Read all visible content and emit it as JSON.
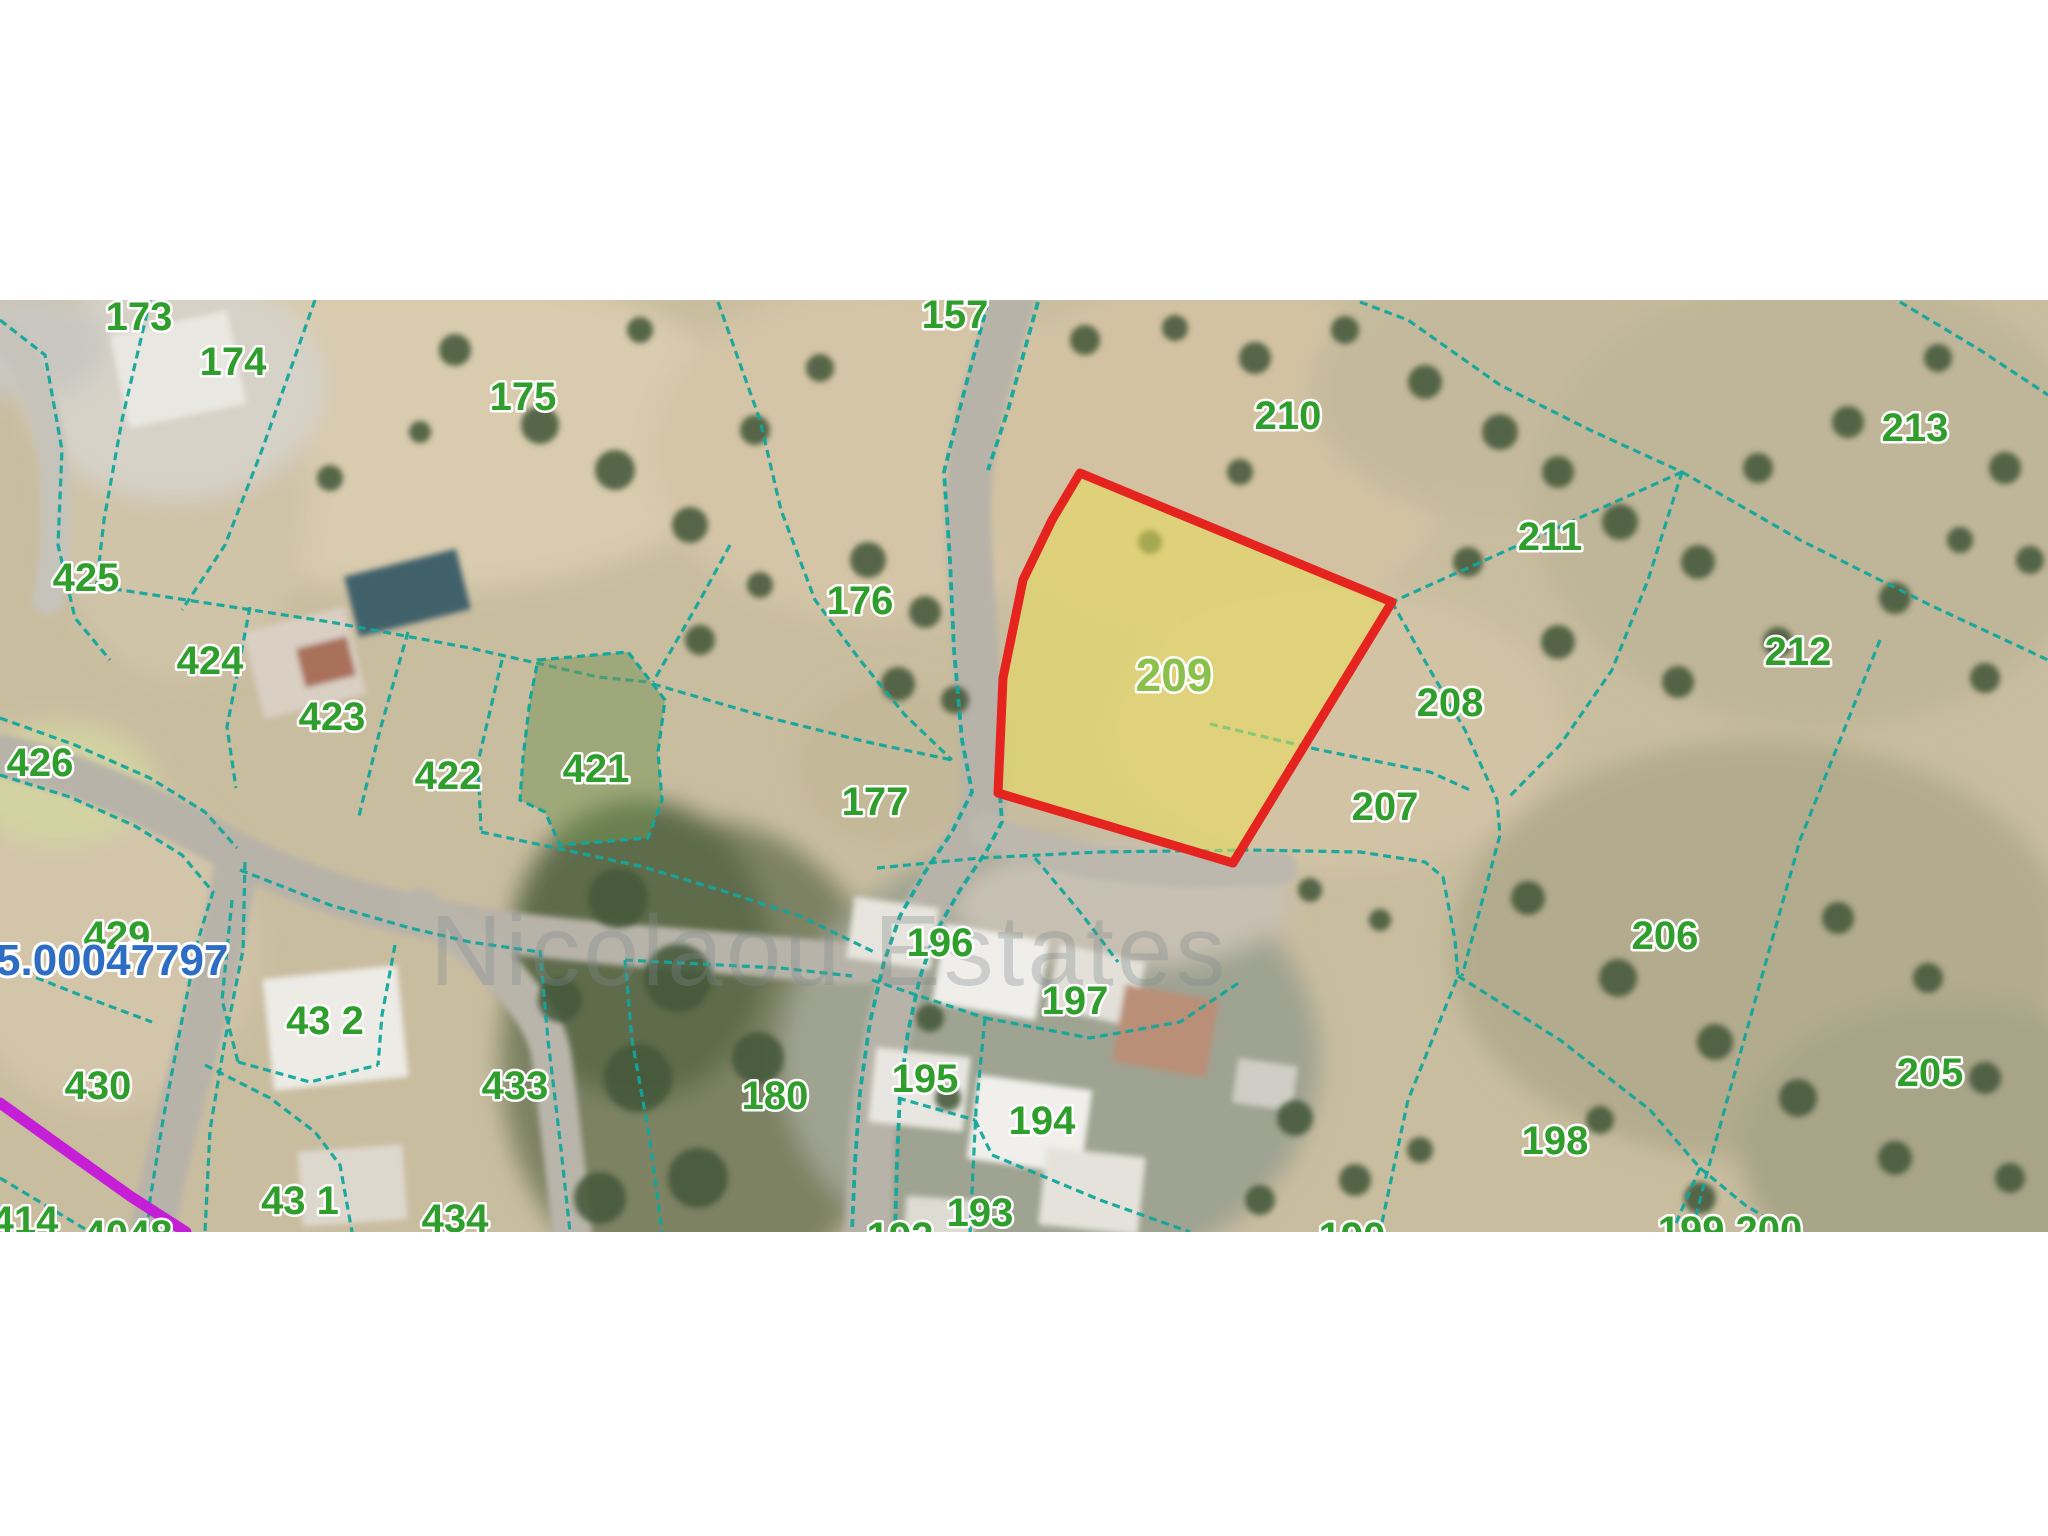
{
  "map": {
    "type": "cadastral-parcel-map",
    "area": {
      "x": 0,
      "y": 300,
      "width": 2048,
      "height": 932
    },
    "colors": {
      "boundary": "#12a79b",
      "label_green": "#2f9e2c",
      "highlight_label_green": "#8cc04c",
      "highlight_stroke": "#e52420",
      "highlight_fill": "rgba(233,222,90,0.55)",
      "green_parcel_fill": "rgba(118,148,84,0.5)",
      "utility_line": "#c41fd6",
      "reference_blue": "#2e6dc4",
      "watermark_gray": "#7e8a8c"
    },
    "watermark": {
      "text": "Nicolaou Estates",
      "x": 430,
      "y": 985,
      "size": 100,
      "opacity": 0.32
    },
    "reference_number": {
      "text": "5.00047797",
      "x": -4,
      "y": 975,
      "size": 44
    },
    "highlight_parcel": {
      "label": "209",
      "points": "1080,473 1392,602 1233,863 998,793 1003,678 1023,580 1052,520"
    },
    "green_parcel": {
      "label": "421",
      "points": "538,660 628,652 665,700 658,752 662,800 648,838 560,845 545,812 520,800 523,758 530,700"
    },
    "utility_line": {
      "points": "0,1103 60,1146 130,1196 186,1232"
    },
    "labels": [
      {
        "text": "173",
        "x": 139,
        "y": 316
      },
      {
        "text": "174",
        "x": 233,
        "y": 361
      },
      {
        "text": "175",
        "x": 523,
        "y": 396
      },
      {
        "text": "157",
        "x": 955,
        "y": 314
      },
      {
        "text": "210",
        "x": 1288,
        "y": 415
      },
      {
        "text": "213",
        "x": 1915,
        "y": 427
      },
      {
        "text": "211",
        "x": 1550,
        "y": 536
      },
      {
        "text": "212",
        "x": 1798,
        "y": 651
      },
      {
        "text": "176",
        "x": 860,
        "y": 600
      },
      {
        "text": "177",
        "x": 875,
        "y": 801
      },
      {
        "text": "209",
        "x": 1174,
        "y": 675,
        "size": 46,
        "highlight": true
      },
      {
        "text": "208",
        "x": 1450,
        "y": 702
      },
      {
        "text": "207",
        "x": 1385,
        "y": 806
      },
      {
        "text": "425",
        "x": 86,
        "y": 577
      },
      {
        "text": "424",
        "x": 210,
        "y": 660
      },
      {
        "text": "423",
        "x": 332,
        "y": 716
      },
      {
        "text": "422",
        "x": 448,
        "y": 775
      },
      {
        "text": "421",
        "x": 596,
        "y": 768
      },
      {
        "text": "426",
        "x": 40,
        "y": 762
      },
      {
        "text": "429",
        "x": 117,
        "y": 935
      },
      {
        "text": "430",
        "x": 98,
        "y": 1085
      },
      {
        "text": "43 2",
        "x": 325,
        "y": 1020
      },
      {
        "text": "433",
        "x": 515,
        "y": 1085
      },
      {
        "text": "43 1",
        "x": 300,
        "y": 1200
      },
      {
        "text": "434",
        "x": 455,
        "y": 1218
      },
      {
        "text": "414",
        "x": 25,
        "y": 1220
      },
      {
        "text": "4048",
        "x": 128,
        "y": 1234
      },
      {
        "text": "180",
        "x": 775,
        "y": 1095
      },
      {
        "text": "196",
        "x": 940,
        "y": 942
      },
      {
        "text": "197",
        "x": 1075,
        "y": 1000
      },
      {
        "text": "195",
        "x": 925,
        "y": 1078
      },
      {
        "text": "194",
        "x": 1042,
        "y": 1120
      },
      {
        "text": "193",
        "x": 980,
        "y": 1212
      },
      {
        "text": "192",
        "x": 900,
        "y": 1236
      },
      {
        "text": "190",
        "x": 1352,
        "y": 1236
      },
      {
        "text": "206",
        "x": 1665,
        "y": 935
      },
      {
        "text": "205",
        "x": 1930,
        "y": 1072
      },
      {
        "text": "198",
        "x": 1555,
        "y": 1140
      },
      {
        "text": "199 200",
        "x": 1730,
        "y": 1230
      }
    ],
    "boundaries": [
      {
        "points": "0,320 45,355 62,450 58,545 75,618 110,660"
      },
      {
        "points": "150,300 122,420 104,520 96,590"
      },
      {
        "points": "315,300 262,450 225,545 182,610"
      },
      {
        "points": "88,585 200,602 330,622 470,648 598,677 648,682"
      },
      {
        "points": "250,607 227,727 236,788"
      },
      {
        "points": "408,632 380,730 358,820"
      },
      {
        "points": "502,660 478,762 481,830"
      },
      {
        "points": "730,545 700,600 653,682"
      },
      {
        "points": "718,302 760,420 781,510 815,600 860,660 905,715 952,760"
      },
      {
        "points": "988,302 962,400 944,472 950,560 954,650 962,740 972,792 952,832 925,872 900,916 884,962 870,1022 860,1092 855,1162 852,1232",
        "w": 3.8
      },
      {
        "points": "1038,302 1008,410 988,470",
        "w": 3.8
      },
      {
        "points": "1000,795 1002,822 986,852 960,890 936,932 920,977 908,1032 900,1092 897,1162 895,1232",
        "w": 3.8
      },
      {
        "points": "653,684 770,718 867,742 952,760"
      },
      {
        "points": "481,832 560,849 640,866 720,890 800,916 874,952"
      },
      {
        "points": "1360,302 1408,320 1500,385 1590,430 1682,472"
      },
      {
        "points": "1682,472 1530,540 1392,602"
      },
      {
        "points": "1682,472 1800,540 1930,605 2048,660"
      },
      {
        "points": "1682,472 1648,580 1612,670 1560,745 1508,798"
      },
      {
        "points": "1392,602 1430,670 1465,730 1497,800 1500,835 1462,976"
      },
      {
        "points": "1880,640 1840,740 1800,840 1762,976 1730,1090 1705,1180 1692,1232"
      },
      {
        "points": "1443,877 1455,940 1458,976 1408,1100 1380,1232"
      },
      {
        "points": "1458,976 1560,1040 1650,1110 1700,1168"
      },
      {
        "points": "1700,1168 1672,1232"
      },
      {
        "points": "1700,1168 1745,1205 1790,1232"
      },
      {
        "points": "1210,724 1320,750 1430,772 1470,790"
      },
      {
        "points": "877,868 980,858 1100,852 1250,850 1360,852 1425,862 1443,877"
      },
      {
        "points": "1035,858 1080,912 1118,962"
      },
      {
        "points": "872,980 985,1018"
      },
      {
        "points": "985,1018 976,1110 970,1232"
      },
      {
        "points": "985,1018 1090,1038 1180,1022 1240,982"
      },
      {
        "points": "898,1098 975,1120"
      },
      {
        "points": "975,1120 992,1155 1100,1200 1190,1232"
      },
      {
        "points": "0,718 75,745 150,778 205,812 237,848"
      },
      {
        "points": "0,775 70,797 135,826 182,855 213,892 198,940 180,1030 163,1120 150,1200 147,1232"
      },
      {
        "points": "245,862 243,950 225,1040 210,1130 205,1232"
      },
      {
        "points": "12,968 80,995 152,1022"
      },
      {
        "points": "232,900 222,1000 238,1062"
      },
      {
        "points": "395,945 382,1015 378,1065"
      },
      {
        "points": "238,1062 310,1082 378,1065"
      },
      {
        "points": "240,870 330,905 410,928 470,942 540,952"
      },
      {
        "points": "540,950 548,1040 560,1140 570,1232"
      },
      {
        "points": "625,960 632,1040 650,1140 662,1232"
      },
      {
        "points": "625,960 700,964 780,968 852,976"
      },
      {
        "points": "205,1065 270,1098 315,1132 340,1165 352,1232"
      },
      {
        "points": "1900,302 1980,350 2048,395"
      },
      {
        "points": "0,1178 45,1205 90,1232"
      }
    ]
  }
}
